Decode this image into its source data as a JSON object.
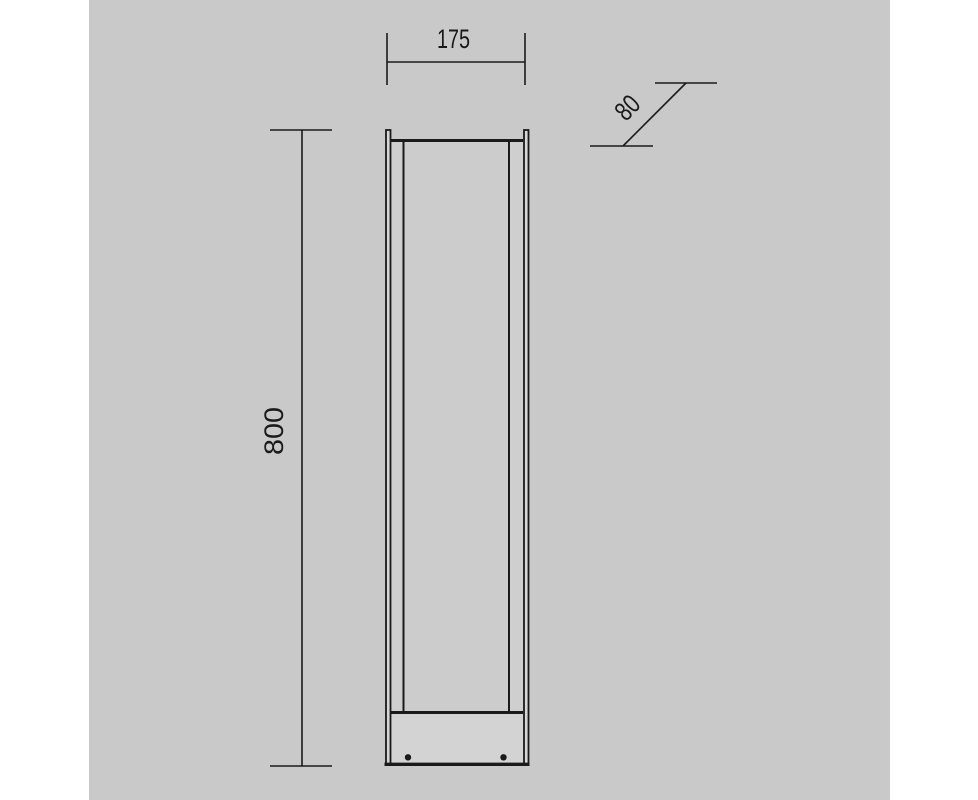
{
  "colors": {
    "page_margin": "#ffffff",
    "canvas_background": "#c9c9c9",
    "line": "#1a1a1a",
    "text": "#1a1a1a",
    "panel_fill": "#cccccc",
    "side_strip_fill": "#cfcfcf",
    "base_fill": "#d3d3d3",
    "plate_fill": "#d6d6d6"
  },
  "dimensions": {
    "width": {
      "value": "175"
    },
    "depth": {
      "value": "80"
    },
    "height": {
      "value": "800"
    }
  }
}
